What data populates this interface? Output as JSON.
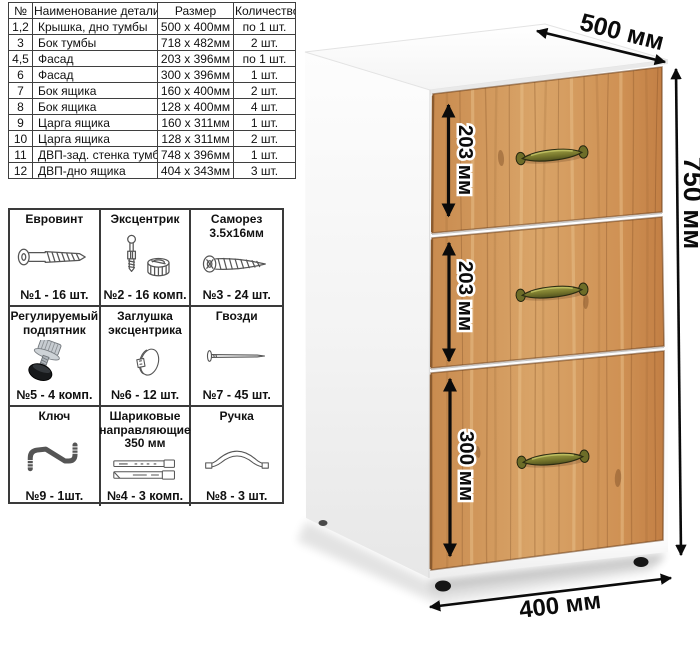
{
  "parts_table": {
    "headers": [
      "№",
      "Наименование детали",
      "Размер",
      "Количество"
    ],
    "rows": [
      [
        "1,2",
        "Крышка, дно тумбы",
        "500 x 400мм",
        "по 1 шт."
      ],
      [
        "3",
        "Бок тумбы",
        "718 x 482мм",
        "2 шт."
      ],
      [
        "4,5",
        "Фасад",
        "203 x 396мм",
        "по 1 шт."
      ],
      [
        "6",
        "Фасад",
        "300 x 396мм",
        "1 шт."
      ],
      [
        "7",
        "Бок ящика",
        "160 x 400мм",
        "2 шт."
      ],
      [
        "8",
        "Бок ящика",
        "128 x 400мм",
        "4 шт."
      ],
      [
        "9",
        "Царга ящика",
        "160 x 311мм",
        "1 шт."
      ],
      [
        "10",
        "Царга ящика",
        "128 x 311мм",
        "2 шт."
      ],
      [
        "11",
        "ДВП-зад. стенка тумбы",
        "748 x 396мм",
        "1 шт."
      ],
      [
        "12",
        "ДВП-дно ящика",
        "404 x 343мм",
        "3 шт."
      ]
    ]
  },
  "hardware": {
    "items": [
      {
        "title": "Евровинт",
        "qty": "№1 - 16 шт.",
        "icon": "euro-screw"
      },
      {
        "title": "Эксцентрик",
        "qty": "№2 - 16 комп.",
        "icon": "cam-lock"
      },
      {
        "title": "Саморез 3.5х16мм",
        "qty": "№3 - 24 шт.",
        "icon": "self-tapping-screw"
      },
      {
        "title": "Регулируемый подпятник",
        "qty": "№5 - 4 комп.",
        "icon": "adjustable-foot"
      },
      {
        "title": "Заглушка эксцентрика",
        "qty": "№6 - 12 шт.",
        "icon": "cam-cap"
      },
      {
        "title": "Гвозди",
        "qty": "№7 - 45 шт.",
        "icon": "nail"
      },
      {
        "title": "Ключ",
        "qty": "№9 - 1шт.",
        "icon": "hex-key"
      },
      {
        "title": "Шариковые направляющие 350 мм",
        "qty": "№4 - 3 комп.",
        "icon": "ball-slides"
      },
      {
        "title": "Ручка",
        "qty": "№8 - 3 шт.",
        "icon": "handle"
      }
    ]
  },
  "dimensions": {
    "width": "500 мм",
    "height": "750 мм",
    "depth": "400 мм",
    "drawer1": "203 мм",
    "drawer2": "203 мм",
    "drawer3": "300 мм"
  },
  "colors": {
    "wood": "#d09257",
    "wood_dark": "#a96b38",
    "handle_brass": "#7b7b2e",
    "arrow": "#0b0b0b",
    "table_border": "#3f3f3f"
  }
}
